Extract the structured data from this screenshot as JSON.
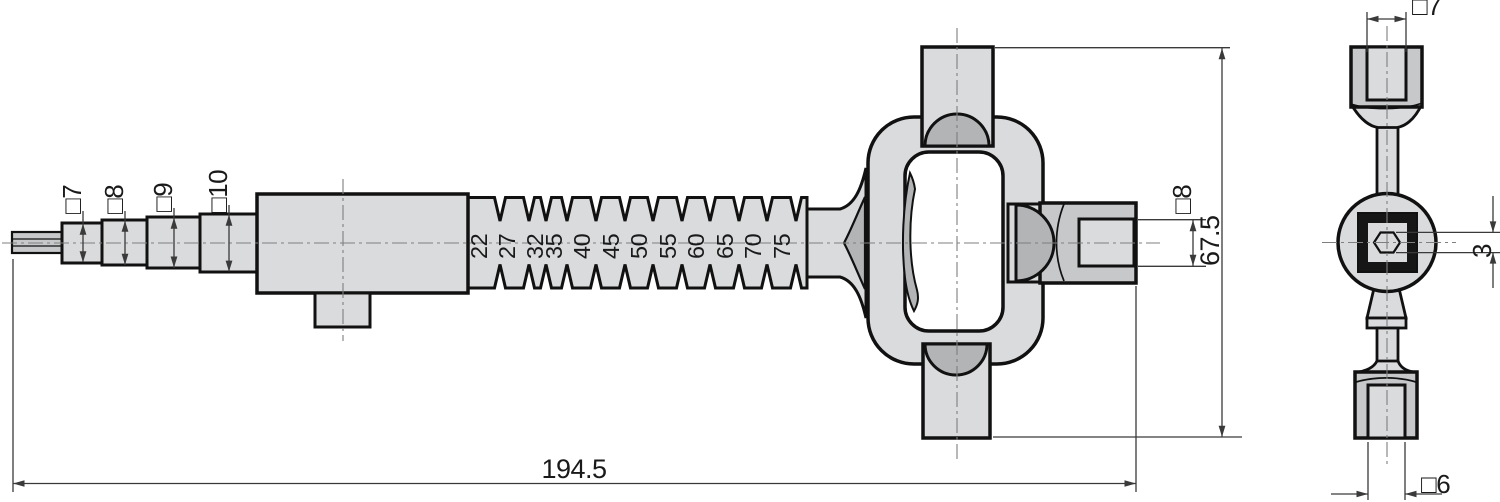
{
  "drawing": {
    "kind": "technical-drawing-two-views",
    "side_view": {
      "step_dimensions": [
        "□7",
        "□8",
        "□9",
        "□10"
      ],
      "depth_scale": [
        "22",
        "27",
        "32",
        "35",
        "40",
        "45",
        "50",
        "55",
        "60",
        "65",
        "70",
        "75"
      ],
      "socket_dimension": "□8",
      "overall_height": "67.5",
      "overall_length": "194.5"
    },
    "end_view": {
      "top_socket_dimension": "□7",
      "hex_dimension": "3",
      "bottom_socket_dimension": "□6"
    },
    "colors": {
      "outline": "#111111",
      "fill_light": "#dadbdd",
      "fill_mid": "#c7c8ca",
      "fill_dark": "#b2b4b6",
      "window": "#ffffff",
      "ring": "#161616",
      "dim": "#3a3a3a",
      "centerline": "#7f7f7f"
    }
  }
}
